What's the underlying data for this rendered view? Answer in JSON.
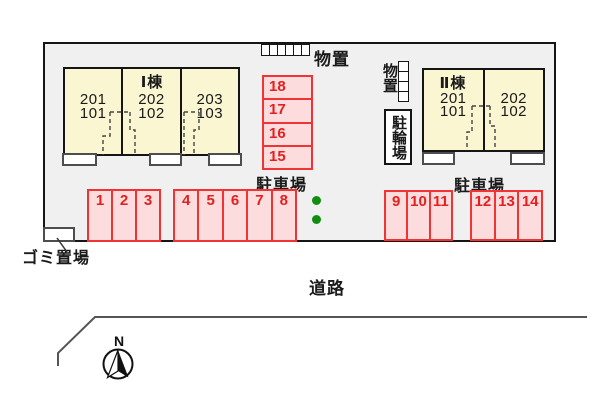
{
  "labels": {
    "storage_top": "物置",
    "storage_right": "物置",
    "bicycle": "駐輪場",
    "parking_left": "駐車場",
    "parking_right": "駐車場",
    "garbage": "ゴミ置場",
    "road": "道路",
    "north": "N"
  },
  "buildings": [
    {
      "name": "Ⅰ棟",
      "units": [
        {
          "upper": "201",
          "lower": "101"
        },
        {
          "upper": "202",
          "lower": "102"
        },
        {
          "upper": "203",
          "lower": "103"
        }
      ]
    },
    {
      "name": "Ⅱ棟",
      "units": [
        {
          "upper": "201",
          "lower": "101"
        },
        {
          "upper": "202",
          "lower": "102"
        }
      ]
    }
  ],
  "parking": {
    "column": [
      "18",
      "17",
      "16",
      "15"
    ],
    "left_a": [
      "1",
      "2",
      "3"
    ],
    "left_b": [
      "4",
      "5",
      "6",
      "7",
      "8"
    ],
    "right_a": [
      "9",
      "10",
      "11"
    ],
    "right_b": [
      "12",
      "13",
      "14"
    ]
  },
  "colors": {
    "site_fill": "#f0f0f0",
    "building_fill": "#faf6d2",
    "parking_fill": "#fcdcdc",
    "parking_border": "#f03333",
    "parking_number": "#e22020",
    "green_dot": "#0f8f0f"
  }
}
